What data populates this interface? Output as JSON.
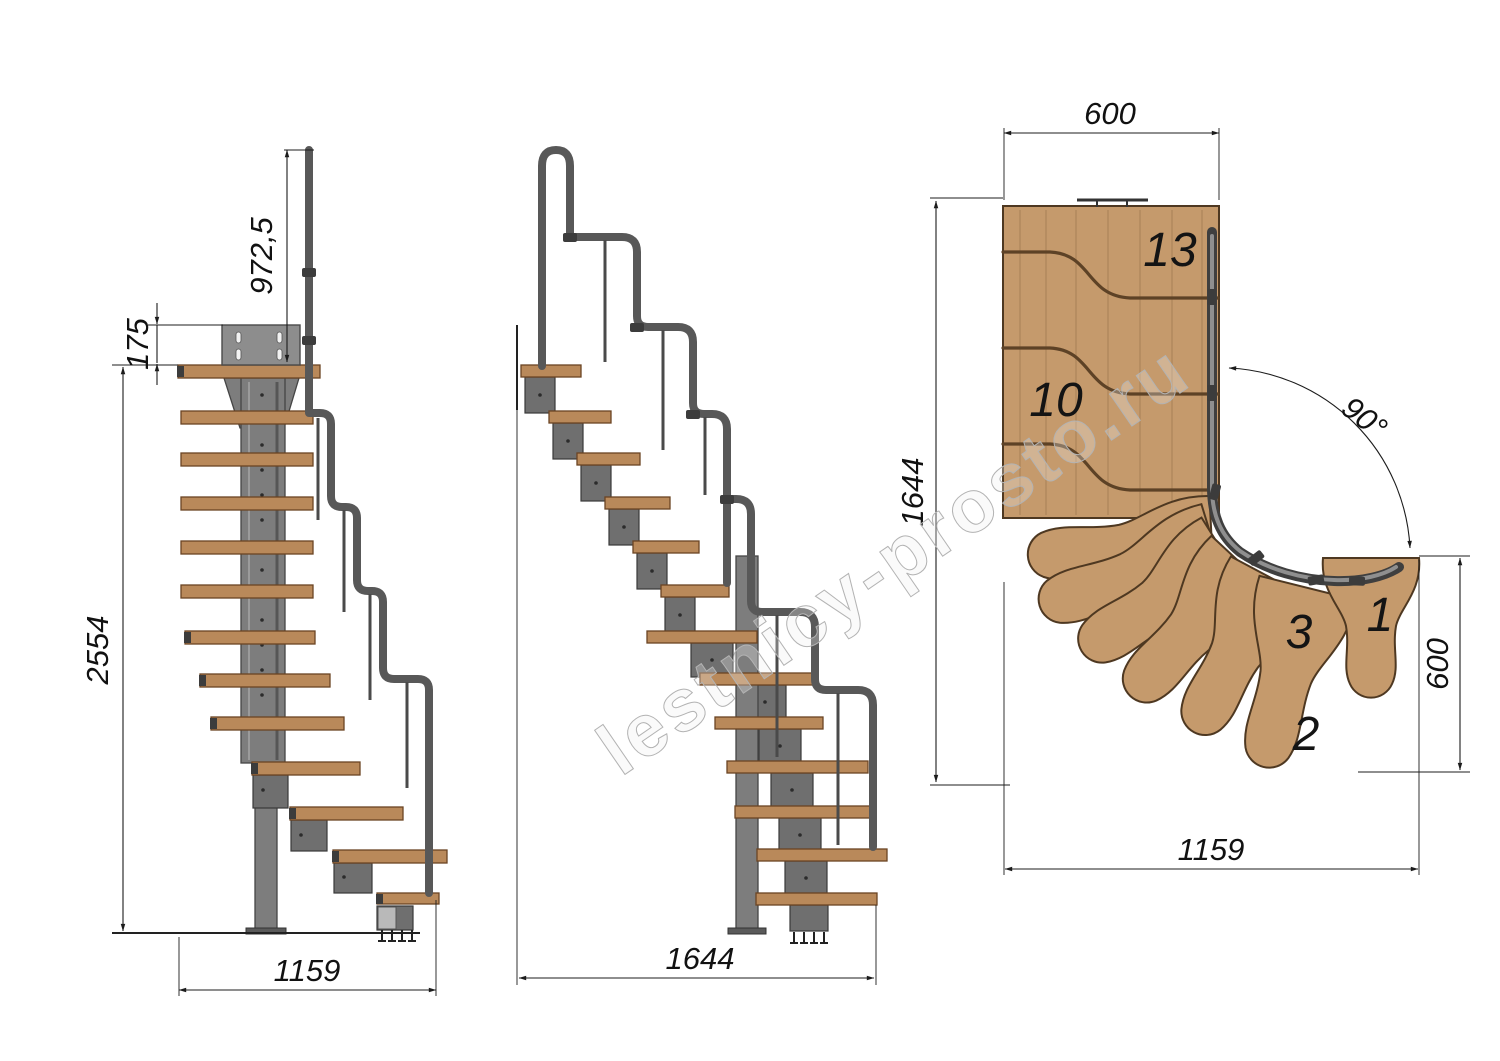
{
  "watermark": {
    "text": "lestnicy-prosto.ru"
  },
  "front_view": {
    "dim_rail_height": "972,5",
    "dim_plate_height": "175",
    "dim_total_height": "2554",
    "dim_base_width": "1159"
  },
  "side_view": {
    "dim_total_run": "1644"
  },
  "plan_view": {
    "dim_platform_width": "600",
    "dim_total_length": "1644",
    "dim_turn_angle": "90°",
    "dim_entry_width": "600",
    "dim_total_width": "1159",
    "steps": {
      "s13": "13",
      "s10": "10",
      "s3": "3",
      "s2": "2",
      "s1": "1"
    }
  },
  "colors": {
    "wood": "#b9895a",
    "plan_wood": "#c59a6c",
    "steel": "#7d7d7d",
    "rail": "#585858",
    "rail_dark": "#3f3f3f",
    "rail_core": "#8f8f8f",
    "dim_line": "#1c1c1c",
    "watermark": "#b3b3b3"
  }
}
